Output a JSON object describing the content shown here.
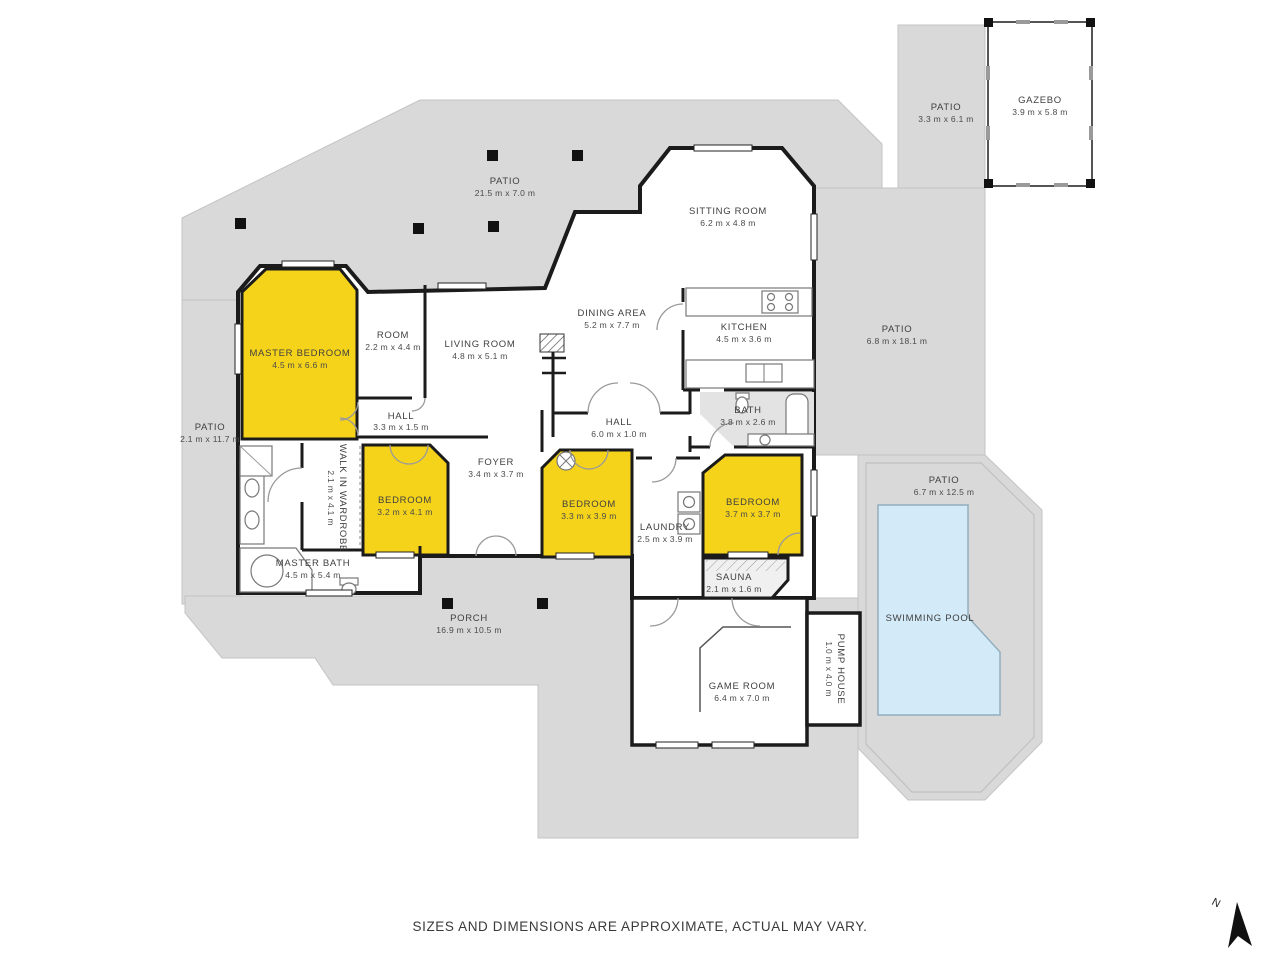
{
  "colors": {
    "patio_grey": "#d9d9d9",
    "patio_border": "#c4c4c4",
    "highlight_yellow": "#f5d31b",
    "pool_blue": "#d3eaf8",
    "wall_black": "#1b1b1b"
  },
  "rooms": {
    "patio_top": {
      "name": "PATIO",
      "dims": "21.5 m x 7.0 m"
    },
    "patio_gazebo": {
      "name": "PATIO",
      "dims": "3.3 m x 6.1 m"
    },
    "gazebo": {
      "name": "GAZEBO",
      "dims": "3.9 m x 5.8 m"
    },
    "sitting_room": {
      "name": "SITTING ROOM",
      "dims": "6.2 m x 4.8 m"
    },
    "dining_area": {
      "name": "DINING AREA",
      "dims": "5.2 m x 7.7 m"
    },
    "kitchen": {
      "name": "KITCHEN",
      "dims": "4.5 m x 3.6 m"
    },
    "living_room": {
      "name": "LIVING ROOM",
      "dims": "4.8 m x 5.1 m"
    },
    "room": {
      "name": "ROOM",
      "dims": "2.2 m x 4.4 m"
    },
    "master_bedroom": {
      "name": "MASTER BEDROOM",
      "dims": "4.5 m x 6.6 m"
    },
    "hall_west": {
      "name": "HALL",
      "dims": "3.3 m x 1.5 m"
    },
    "hall_east": {
      "name": "HALL",
      "dims": "6.0 m x 1.0 m"
    },
    "bath": {
      "name": "BATH",
      "dims": "3.8 m x 2.6 m"
    },
    "patio_left": {
      "name": "PATIO",
      "dims": "2.1 m x 11.7 m"
    },
    "patio_right": {
      "name": "PATIO",
      "dims": "6.8 m x 18.1 m"
    },
    "walk_in_wardrobe": {
      "name": "WALK IN WARDROBE",
      "dims": "2.1 m x 4.1 m"
    },
    "foyer": {
      "name": "FOYER",
      "dims": "3.4 m x 3.7 m"
    },
    "bedroom_west": {
      "name": "BEDROOM",
      "dims": "3.2 m x 4.1 m"
    },
    "bedroom_center": {
      "name": "BEDROOM",
      "dims": "3.3 m x 3.9 m"
    },
    "bedroom_east": {
      "name": "BEDROOM",
      "dims": "3.7 m x 3.7 m"
    },
    "laundry": {
      "name": "LAUNDRY",
      "dims": "2.5 m x 3.9 m"
    },
    "master_bath": {
      "name": "MASTER BATH",
      "dims": "4.5 m x 5.4 m"
    },
    "sauna": {
      "name": "SAUNA",
      "dims": "2.1 m x 1.6 m"
    },
    "porch": {
      "name": "PORCH",
      "dims": "16.9 m x 10.5 m"
    },
    "game_room": {
      "name": "GAME ROOM",
      "dims": "6.4 m x 7.0 m"
    },
    "pump_house": {
      "name": "PUMP HOUSE",
      "dims": "1.0 m x 4.0 m"
    },
    "patio_pool": {
      "name": "PATIO",
      "dims": "6.7 m x 12.5 m"
    },
    "swimming_pool": {
      "name": "SWIMMING POOL",
      "dims": ""
    }
  },
  "compass": {
    "north_label": "N"
  },
  "footer": {
    "disclaimer": "SIZES AND DIMENSIONS ARE APPROXIMATE, ACTUAL MAY VARY."
  }
}
